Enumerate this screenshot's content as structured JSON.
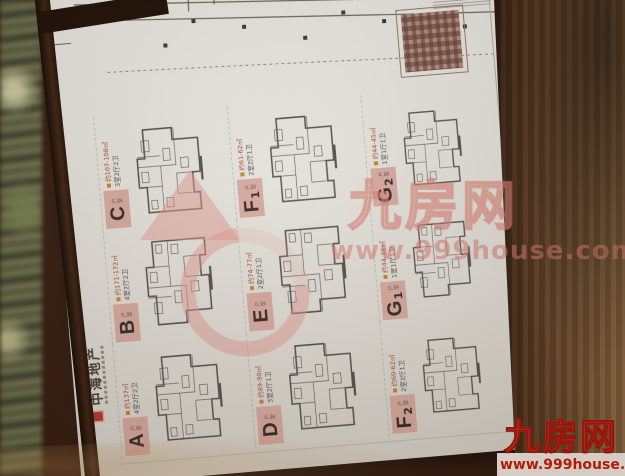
{
  "photo": {
    "watermark": {
      "brand": "九房网",
      "url": "www.999house.com"
    },
    "corner_logo": {
      "brand": "九房网",
      "url": "www.999house.com"
    }
  },
  "poster": {
    "developer": {
      "name": "中海地产"
    },
    "unit_tag": "户型",
    "units": [
      {
        "letter": "A",
        "sub": "",
        "area": "约137㎡",
        "rooms": "4室2厅2卫"
      },
      {
        "letter": "B",
        "sub": "",
        "area": "约171-172㎡",
        "rooms": "4室2厅2卫"
      },
      {
        "letter": "C",
        "sub": "",
        "area": "约107-108㎡",
        "rooms": "3室2厅2卫"
      },
      {
        "letter": "D",
        "sub": "",
        "area": "约89-90㎡",
        "rooms": "3室2厅1卫"
      },
      {
        "letter": "E",
        "sub": "",
        "area": "约74-77㎡",
        "rooms": "2室2厅1卫"
      },
      {
        "letter": "F",
        "sub": "1",
        "area": "约61-62㎡",
        "rooms": "2室2厅1卫"
      },
      {
        "letter": "F",
        "sub": "2",
        "area": "约60-62㎡",
        "rooms": "2室2厅1卫"
      },
      {
        "letter": "G",
        "sub": "1",
        "area": "约44-46㎡",
        "rooms": "1室1厅1卫"
      },
      {
        "letter": "G",
        "sub": "2",
        "area": "约44-45㎡",
        "rooms": "1室1厅1卫"
      }
    ],
    "legend_colors": [
      "#9fc4e4",
      "#2a3b8f",
      "#7fae4f",
      "#a92636"
    ]
  }
}
